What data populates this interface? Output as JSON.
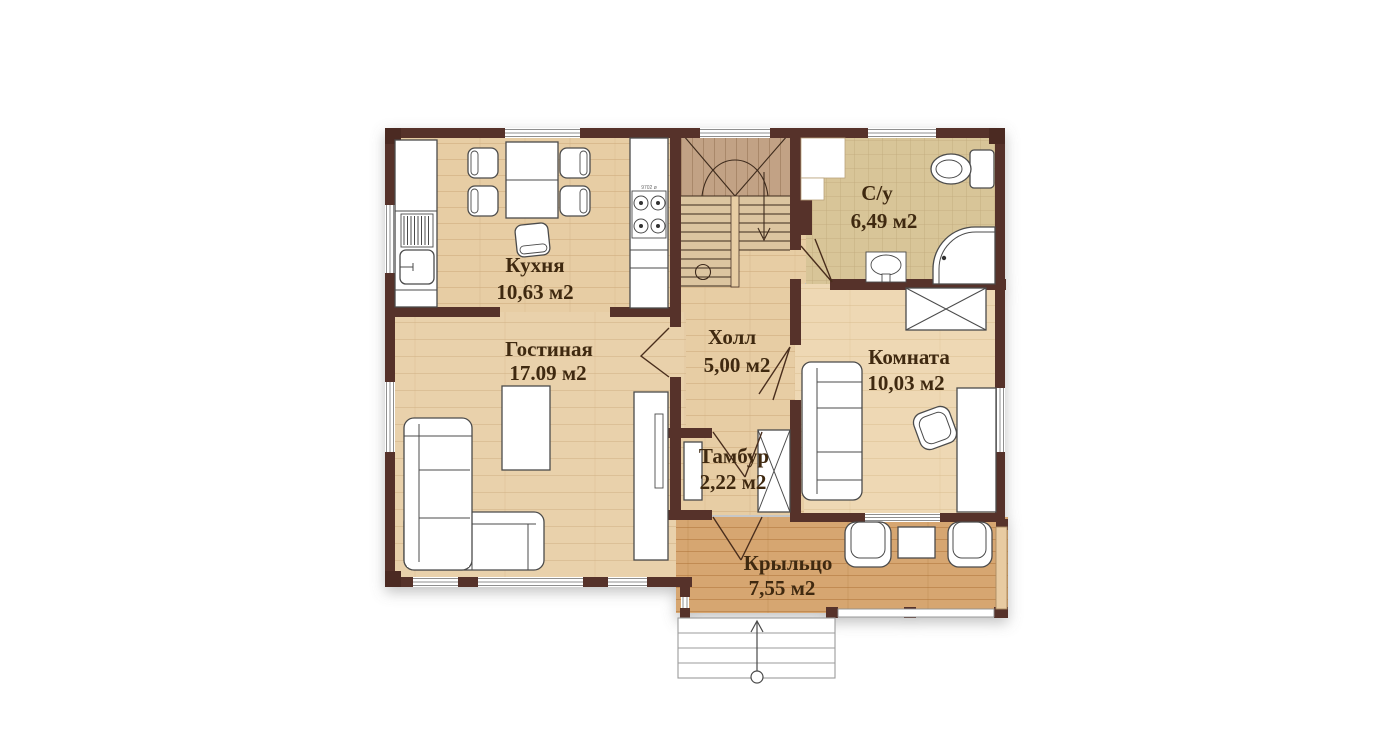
{
  "plan": {
    "type": "floor-plan",
    "language": "ru",
    "rooms": {
      "kitchen": {
        "name": "Кухня",
        "area": "10,63 м2"
      },
      "living": {
        "name": "Гостиная",
        "area": "17.09 м2"
      },
      "hall": {
        "name": "Холл",
        "area": "5,00 м2"
      },
      "bathroom": {
        "name": "С/у",
        "area": "6,49 м2"
      },
      "room": {
        "name": "Комната",
        "area": "10,03 м2"
      },
      "vestibule": {
        "name": "Тамбур",
        "area": "2,22 м2"
      },
      "porch": {
        "name": "Крыльцо",
        "area": "7,55 м2"
      }
    },
    "stove_marking": "9702 ø",
    "colors": {
      "wall": "#57302a",
      "wood_floor": "#e7cda4",
      "living_floor": "#e9d1ab",
      "room_floor": "#eed8b4",
      "porch_floor": "#d6a671",
      "bathroom_tile": "#d8c598",
      "stair_landing": "#c2a285",
      "label_text": "#3f2910"
    }
  }
}
